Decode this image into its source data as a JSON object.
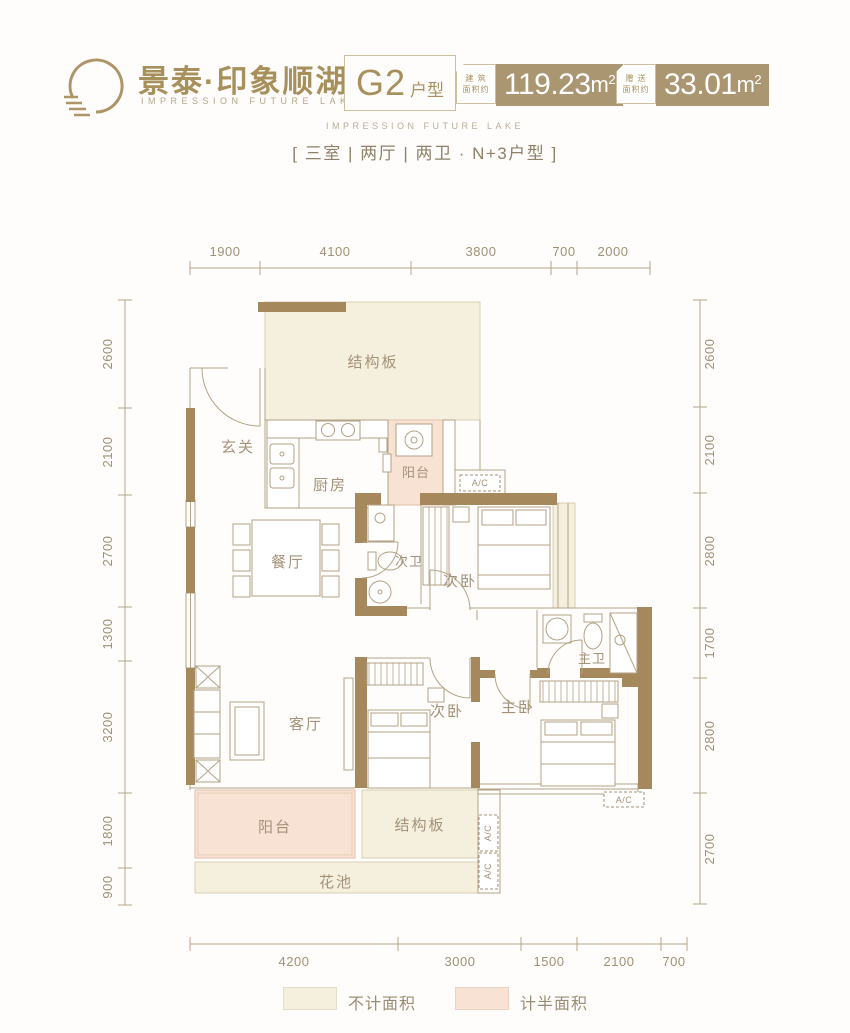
{
  "header": {
    "logo": {
      "brand_cn": "景泰·印象顺湖",
      "brand_en": "IMPRESSION FUTURE LAKE"
    },
    "unit": {
      "code": "G2",
      "suffix": "户型"
    },
    "areas": [
      {
        "label_line1": "建 筑",
        "label_line2": "面积约",
        "value": "119.23",
        "unit": "m",
        "sup": "2"
      },
      {
        "label_line1": "赠 送",
        "label_line2": "面积约",
        "value": "33.01",
        "unit": "m",
        "sup": "2"
      }
    ],
    "subtitle_en": "IMPRESSION FUTURE LAKE",
    "subtitle_cn": "[ 三室 | 两厅 | 两卫 · N+3户型 ]"
  },
  "dimensions": {
    "top": [
      "1900",
      "4100",
      "3800",
      "700",
      "2000"
    ],
    "left": [
      "2600",
      "2100",
      "2700",
      "1300",
      "3200",
      "1800",
      "900"
    ],
    "right": [
      "2600",
      "2100",
      "2800",
      "1700",
      "2800",
      "2700"
    ],
    "bottom": [
      "4200",
      "3000",
      "1500",
      "2100",
      "700"
    ]
  },
  "rooms": {
    "slab_top": "结构板",
    "foyer": "玄关",
    "kitchen": "厨房",
    "balcony_top": "阳台",
    "dining": "餐厅",
    "bath2": "次卫",
    "bedroom2a": "次卧",
    "bath1": "主卫",
    "living": "客厅",
    "bedroom2b": "次卧",
    "bedroom1": "主卧",
    "balcony_bottom": "阳台",
    "slab_bottom": "结构板",
    "flower_bed": "花池",
    "ac": "A/C"
  },
  "legend": [
    {
      "label": "不计面积",
      "color": "#f5f0de"
    },
    {
      "label": "计半面积",
      "color": "#f8e2d4"
    }
  ],
  "colors": {
    "wall": "#a5885c",
    "line": "#b3a285",
    "cream": "#f5f0de",
    "pink": "#f8e2d4",
    "badge": "#ab9672",
    "brand_gold": "#a8905c"
  }
}
